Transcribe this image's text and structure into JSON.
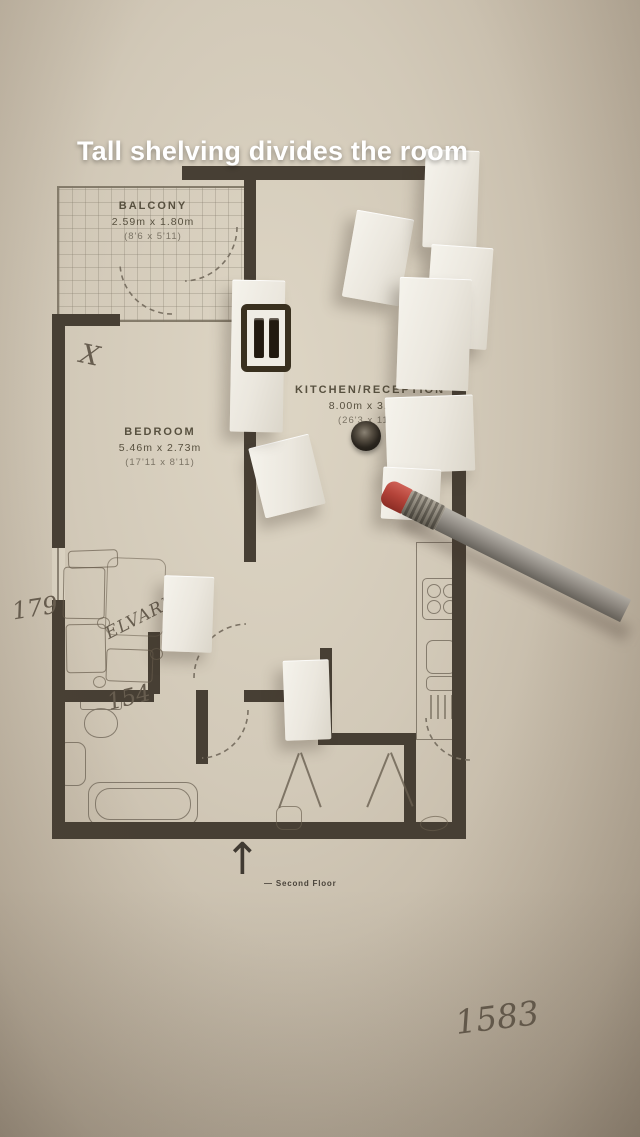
{
  "caption": "Tall shelving divides the room",
  "floorplan": {
    "rooms": [
      {
        "name": "BALCONY",
        "metric": "2.59m x 1.80m",
        "imperial": "(8'6 x 5'11)"
      },
      {
        "name": "BEDROOM",
        "metric": "5.46m x 2.73m",
        "imperial": "(17'11 x 8'11)"
      },
      {
        "name": "KITCHEN/RECEPTION",
        "metric": "8.00m x 3.36m",
        "imperial": "(26'3 x 11'0)"
      }
    ],
    "north_arrow": "↑",
    "floor_note": "—  Second Floor"
  },
  "handwriting": {
    "cross": "X",
    "num_left": "179",
    "shelving_name": "ELVARLI",
    "num_mid": "154",
    "num_bottom": "1583"
  },
  "colors": {
    "wall": "#473f34",
    "paper": "#d2c9b8",
    "caption_text": "#ffffff",
    "eraser_red": "#b5443a",
    "pencil_gray": "#948f88",
    "foam_white": "#f0ede5"
  }
}
